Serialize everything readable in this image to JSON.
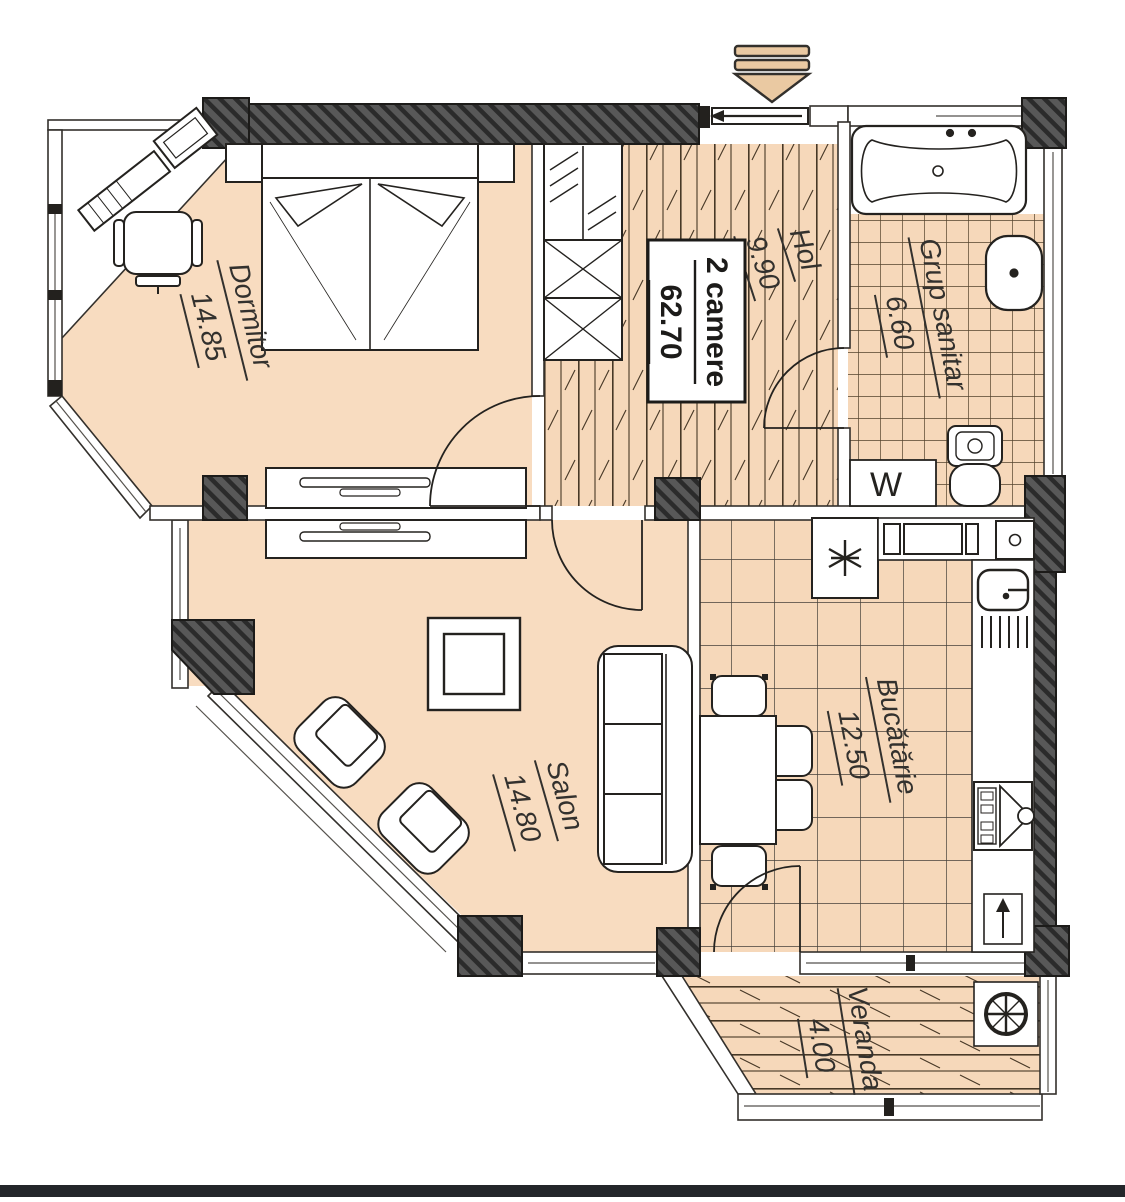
{
  "plan": {
    "title": {
      "type_label": "2 camere",
      "area": "62.70"
    },
    "rooms": [
      {
        "name": "Dormitor",
        "area": "14.85"
      },
      {
        "name": "Hol",
        "area": "9.90"
      },
      {
        "name": "Grup sanitar",
        "area": "6.60"
      },
      {
        "name": "Salon",
        "area": "14.80"
      },
      {
        "name": "Bucătărie",
        "area": "12.50"
      },
      {
        "name": "Veranda",
        "area": "4.00"
      }
    ],
    "labels": {
      "washing_machine": "W"
    },
    "icons": {
      "entry": "entrance-arrow",
      "fridge": "snowflake-star",
      "floor_drain": "crossed-circle"
    },
    "colors": {
      "floor": "#f6d8ba",
      "wall_dark": "#4f4f4f",
      "line": "#24221f",
      "footer_bar": "#23262a"
    }
  }
}
